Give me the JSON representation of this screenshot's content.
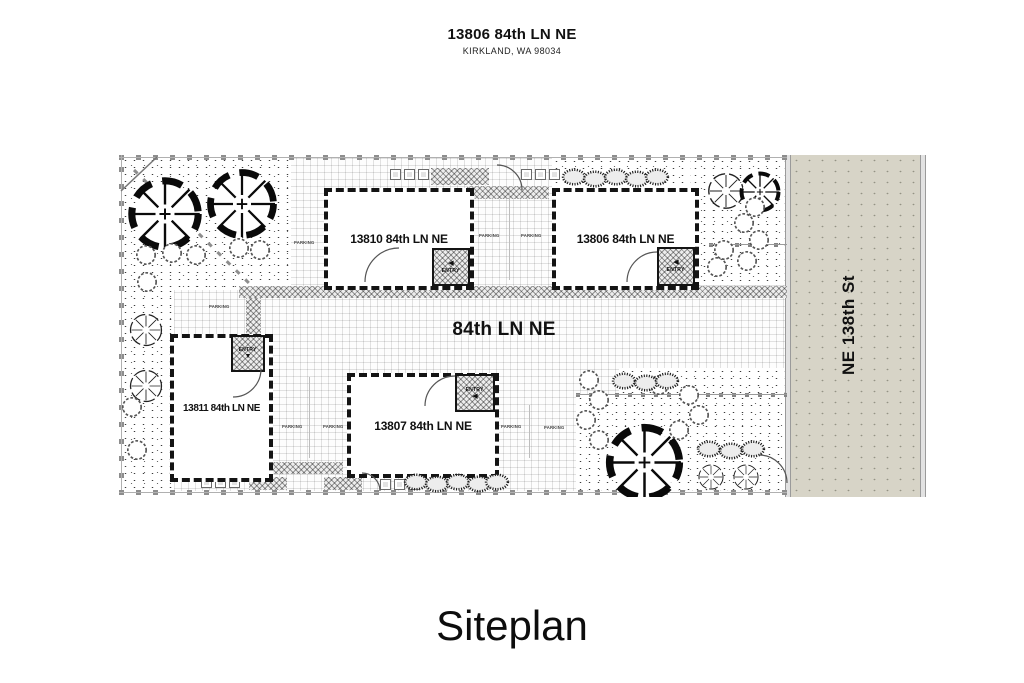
{
  "header": {
    "title": "13806 84th LN NE",
    "subtitle": "KIRKLAND, WA 98034"
  },
  "plan": {
    "lane_label": "84th LN NE",
    "street_label": "NE 138th St",
    "parking_label": "PARKING",
    "entry_label": "ENTRY",
    "buildings": [
      {
        "label": "13810 84th LN NE"
      },
      {
        "label": "13806 84th LN NE"
      },
      {
        "label": "13811 84th LN NE"
      },
      {
        "label": "13807 84th LN NE"
      }
    ],
    "icons": {
      "arrow_left": "◀",
      "arrow_down": "▼"
    },
    "colors": {
      "street_fill": "#d7d4c7",
      "boundary_marker": "#8d8d8d",
      "building_wall": "#141414"
    }
  },
  "footer": {
    "title": "Siteplan"
  }
}
